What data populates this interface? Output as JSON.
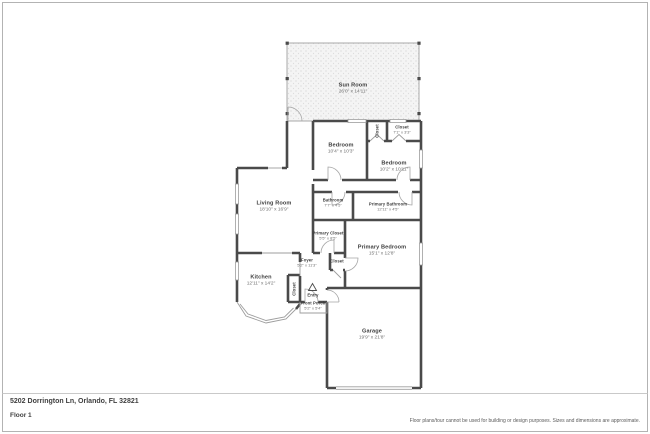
{
  "page": {
    "title": "Floor plan - 5202 Dorrington Ln",
    "footer": {
      "address": "5202 Dorrington Ln, Orlando, FL 32821",
      "floor_label": "Floor 1",
      "disclaimer": "Floor plans/tour cannot be used for building or design purposes. Sizes and dimensions are approximate."
    },
    "colors": {
      "wall": "#4a4a4a",
      "thin_line": "#9d9d9d",
      "hatch_dot": "#d2d2d2",
      "page_border": "#b3b3b3",
      "label_text": "#3d3d3d",
      "dim_text": "#6e6e6e"
    }
  },
  "rooms": [
    {
      "id": "sun-room",
      "name": "Sun Room",
      "dims": "26'0\" x 14'11\""
    },
    {
      "id": "bedroom-1",
      "name": "Bedroom",
      "dims": "10'4\" x 10'3\""
    },
    {
      "id": "closet-hall",
      "name": "Closet",
      "dims": ""
    },
    {
      "id": "closet-2",
      "name": "Closet",
      "dims": "7'1\" x 3'3\""
    },
    {
      "id": "bedroom-2",
      "name": "Bedroom",
      "dims": "10'2\" x 10'11\""
    },
    {
      "id": "bathroom",
      "name": "Bathroom",
      "dims": "7'7\" x 4'5\""
    },
    {
      "id": "primary-bathroom",
      "name": "Primary Bathroom",
      "dims": "12'11\" x 4'5\""
    },
    {
      "id": "living-room",
      "name": "Living Room",
      "dims": "18'10\" x 16'9\""
    },
    {
      "id": "primary-closet",
      "name": "Primary Closet",
      "dims": "5'5\" x 8'5\""
    },
    {
      "id": "primary-bedroom",
      "name": "Primary Bedroom",
      "dims": "15'1\" x 12'8\""
    },
    {
      "id": "foyer",
      "name": "Foyer",
      "dims": "5'2\" x 11'3\""
    },
    {
      "id": "closet-foyer",
      "name": "Closet",
      "dims": ""
    },
    {
      "id": "kitchen",
      "name": "Kitchen",
      "dims": "12'11\" x 14'2\""
    },
    {
      "id": "closet-entry",
      "name": "Closet",
      "dims": ""
    },
    {
      "id": "entry",
      "name": "Entry",
      "dims": ""
    },
    {
      "id": "front-porch",
      "name": "Front Porch",
      "dims": "5'2\" x 5'4\""
    },
    {
      "id": "garage",
      "name": "Garage",
      "dims": "19'9\" x 21'8\""
    }
  ]
}
